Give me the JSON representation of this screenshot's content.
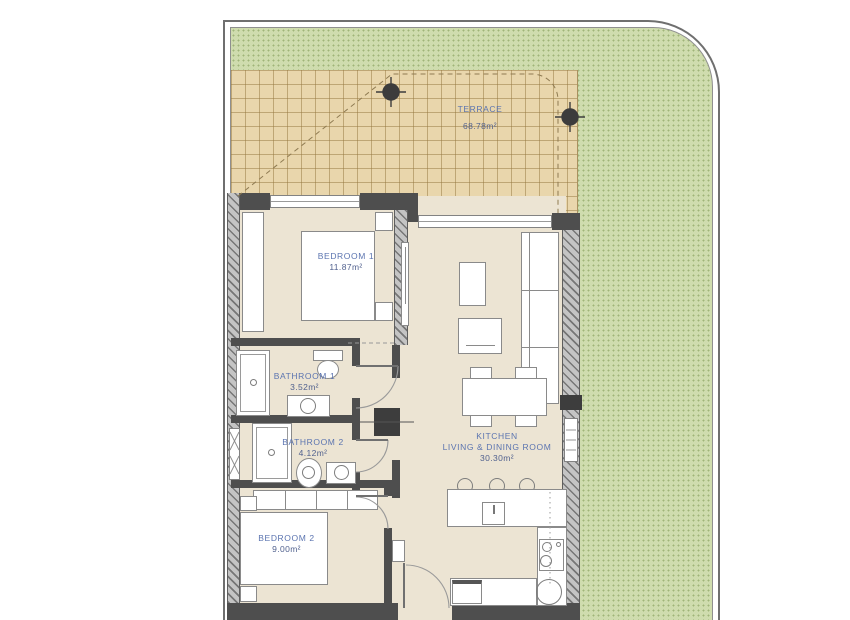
{
  "plan": {
    "type": "apartment-floor-plan",
    "colors": {
      "label_blue": "#5b74b0",
      "area_blue": "#51618e",
      "garden_green": "#cfdcae",
      "terrace_tan": "#e9d6ac",
      "wall_gray": "#4e4e4e",
      "floor_beige": "#ece4d3"
    },
    "icons": {
      "column_marker": "filled circle with survey cross",
      "door_swing": "quarter-circle arc"
    }
  },
  "rooms": {
    "terrace": {
      "name": "TERRACE",
      "area": "68.78m²"
    },
    "bedroom1": {
      "name": "BEDROOM 1",
      "area": "11.87m²"
    },
    "bathroom1": {
      "name": "BATHROOM 1",
      "area": "3.52m²"
    },
    "bathroom2": {
      "name": "BATHROOM 2",
      "area": "4.12m²"
    },
    "bedroom2": {
      "name": "BEDROOM 2",
      "area": "9.00m²"
    },
    "kitchen": {
      "line1": "KITCHEN",
      "line2": "LIVING & DINING ROOM",
      "area": "30.30m²"
    }
  }
}
